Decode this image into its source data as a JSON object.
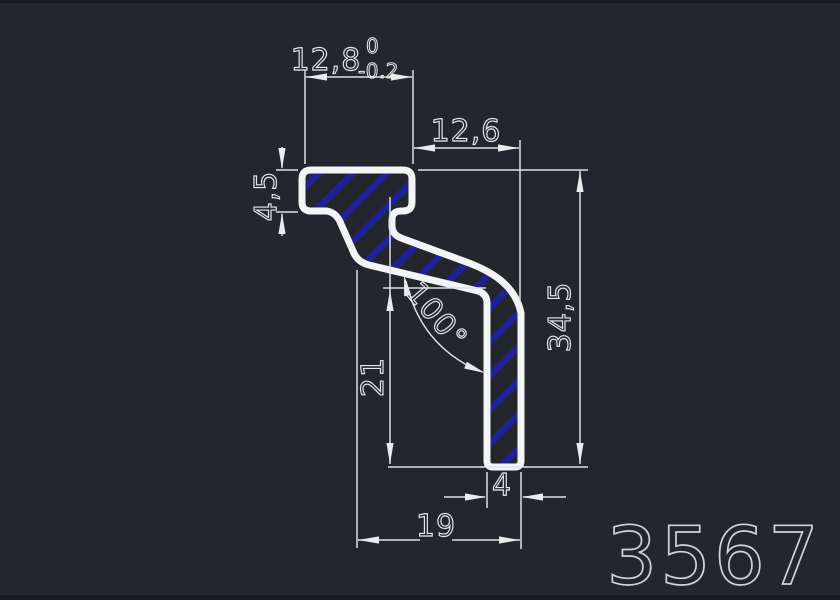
{
  "canvas": {
    "background_color": "#23272c",
    "outline_color": "#f2f4f6",
    "hatch_color": "#20209a",
    "dimension_color": "#e6e9eb",
    "part_number_color": "#ced3d6"
  },
  "dimensions": {
    "top_width": {
      "value": "12,8",
      "tolerance_upper": "0",
      "tolerance_lower": "-0.2"
    },
    "step_width": {
      "value": "12,6"
    },
    "flange_thickness": {
      "value": "4,5"
    },
    "overall_height": {
      "value": "34,5"
    },
    "leg_height": {
      "value": "21"
    },
    "angle": {
      "value": "100°"
    },
    "leg_width": {
      "value": "4"
    },
    "bottom_width": {
      "value": "19"
    }
  },
  "part_number": "3567"
}
